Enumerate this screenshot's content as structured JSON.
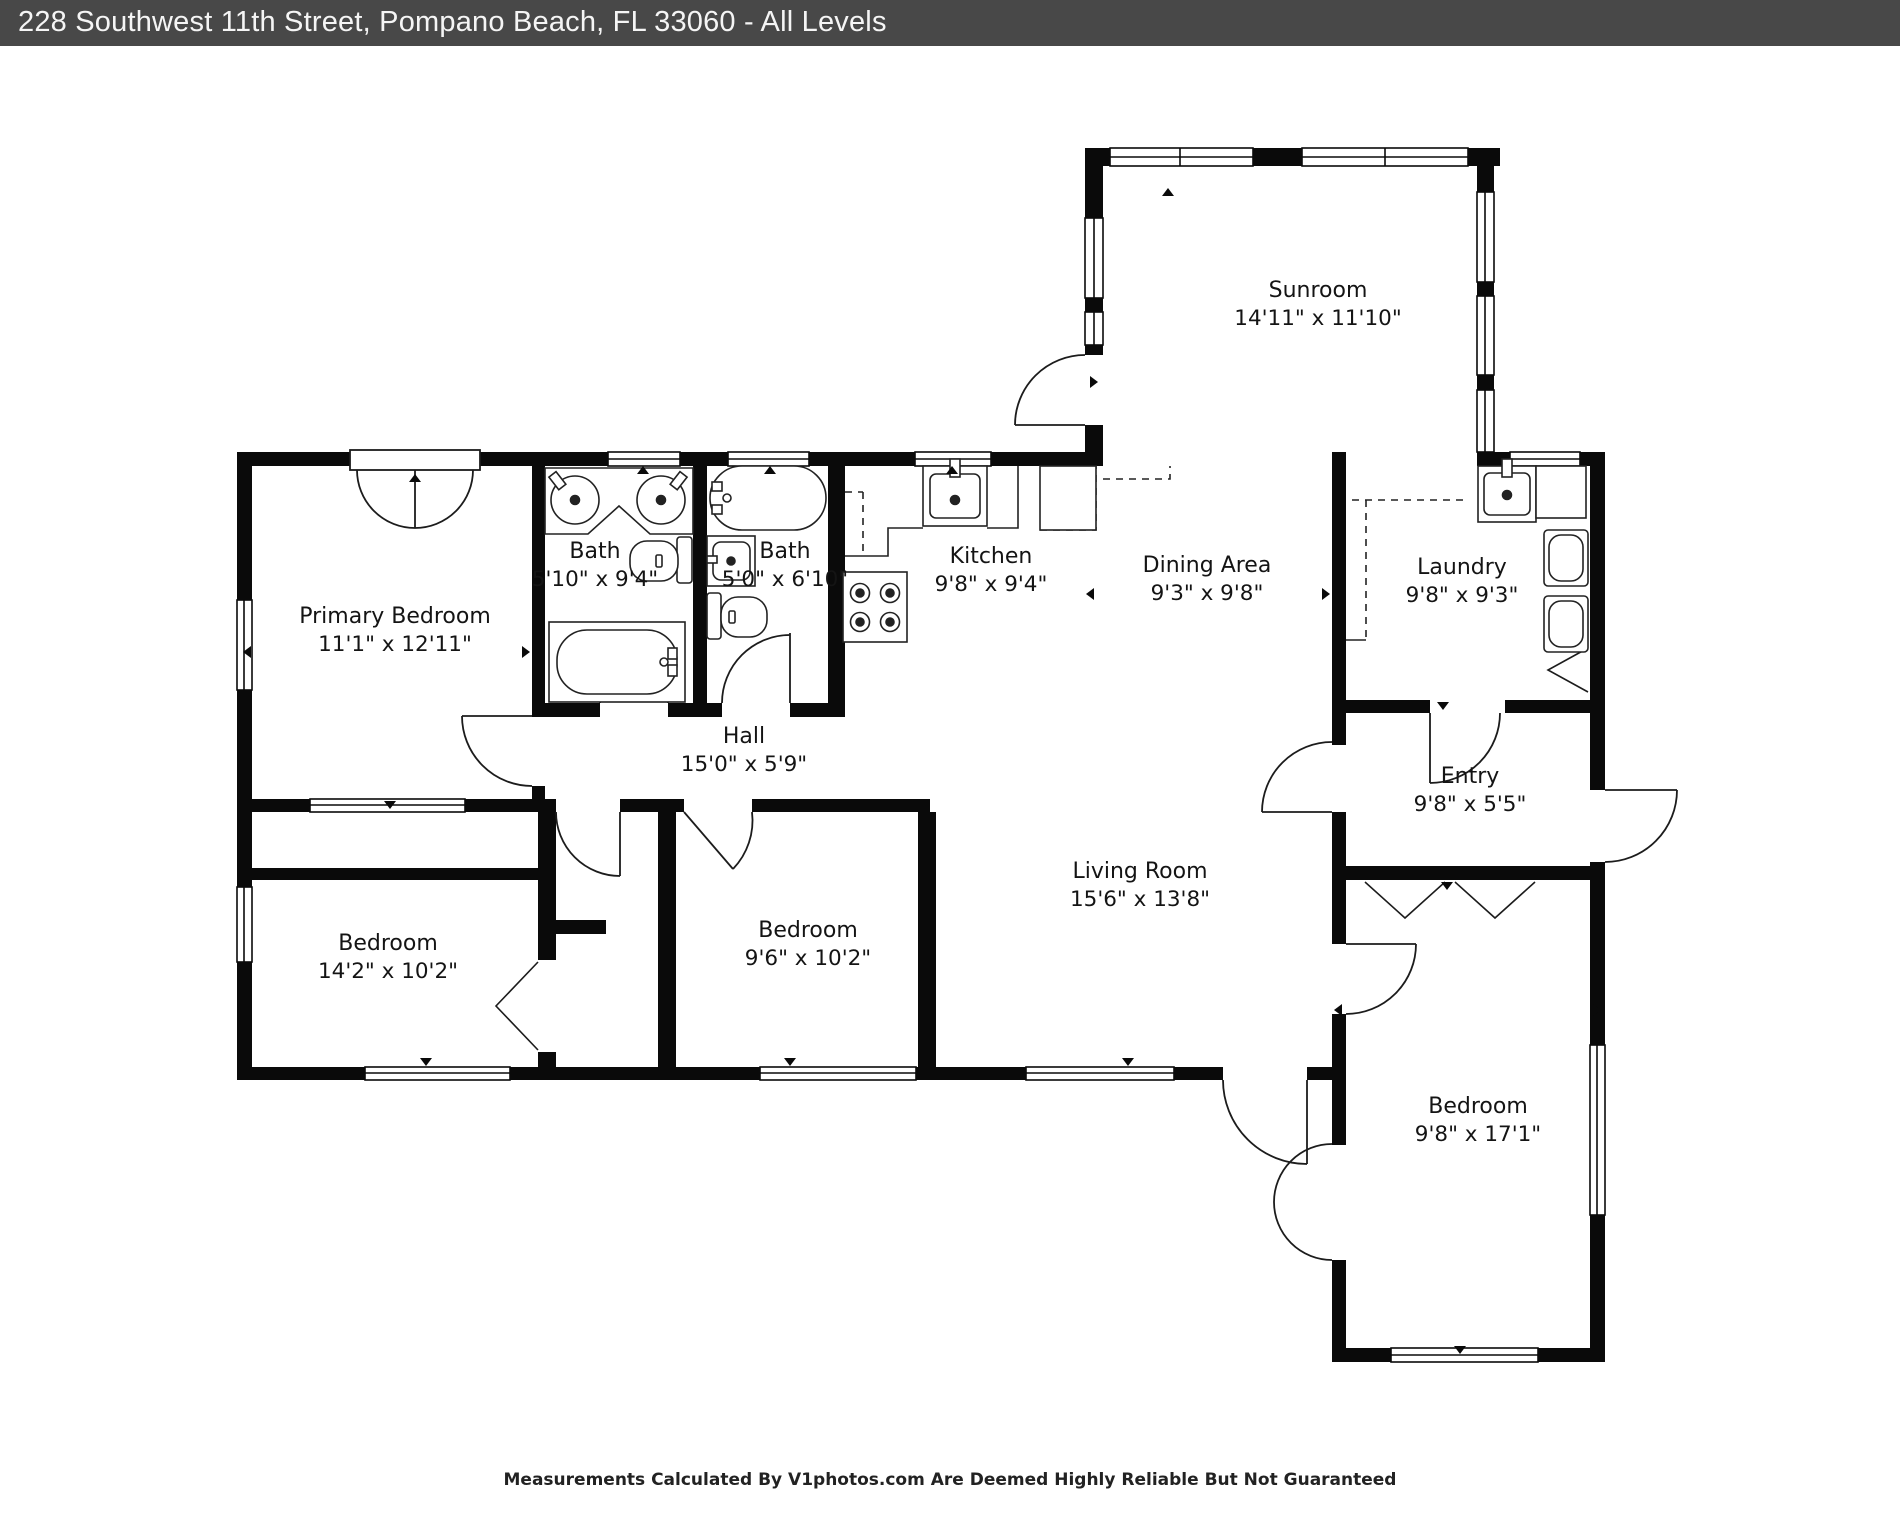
{
  "header": {
    "title": "228 Southwest 11th Street, Pompano Beach, FL 33060 - All Levels",
    "bg_color": "#484848",
    "text_color": "#f5f5f5"
  },
  "footer": {
    "disclaimer": "Measurements Calculated By V1photos.com Are Deemed Highly Reliable But Not Guaranteed"
  },
  "colors": {
    "wall": "#0a0a0a",
    "fixture_stroke": "#222222",
    "label_text": "#141414"
  },
  "icons": {
    "fixtures": [
      "bathtub-icon",
      "sink-icon",
      "toilet-icon",
      "stove-icon",
      "washer-icon",
      "fridge-icon",
      "door-swing-icon",
      "window-icon"
    ]
  },
  "rooms": {
    "sunroom": {
      "name": "Sunroom",
      "dims": "14'11\" x 11'10\""
    },
    "primary": {
      "name": "Primary Bedroom",
      "dims": "11'1\" x 12'11\""
    },
    "bath1": {
      "name": "Bath",
      "dims": "5'10\" x 9'4\""
    },
    "bath2": {
      "name": "Bath",
      "dims": "5'0\" x 6'10\""
    },
    "kitchen": {
      "name": "Kitchen",
      "dims": "9'8\" x 9'4\""
    },
    "dining": {
      "name": "Dining Area",
      "dims": "9'3\" x 9'8\""
    },
    "laundry": {
      "name": "Laundry",
      "dims": "9'8\" x 9'3\""
    },
    "hall": {
      "name": "Hall",
      "dims": "15'0\" x 5'9\""
    },
    "entry": {
      "name": "Entry",
      "dims": "9'8\" x 5'5\""
    },
    "living": {
      "name": "Living Room",
      "dims": "15'6\" x 13'8\""
    },
    "bed_left": {
      "name": "Bedroom",
      "dims": "14'2\" x 10'2\""
    },
    "bed_mid": {
      "name": "Bedroom",
      "dims": "9'6\" x 10'2\""
    },
    "bed_right": {
      "name": "Bedroom",
      "dims": "9'8\" x 17'1\""
    }
  }
}
